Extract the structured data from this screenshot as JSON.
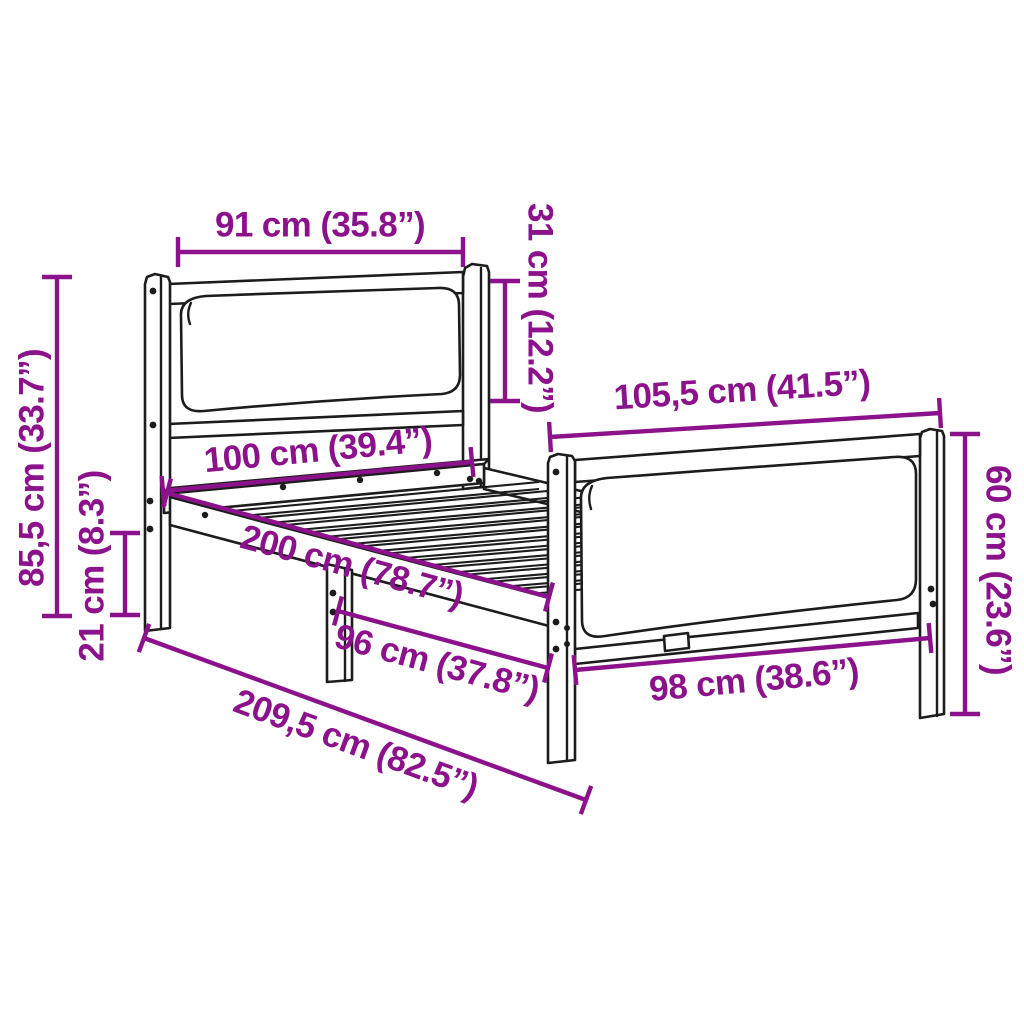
{
  "diagram": {
    "type": "product-dimension-diagram",
    "subject": "bed-frame-with-headboard-and-footboard",
    "colors": {
      "dimension_accent": "#8C128C",
      "outline": "#1c1c1c",
      "background": "#ffffff"
    },
    "dimensions": {
      "headboard_width": "91 cm (35.8”)",
      "headboard_panel_height": "31 cm (12.2”)",
      "headboard_height": "85,5 cm (33.7”)",
      "front_leg_height": "21 cm (8.3”)",
      "bed_width": "100 cm (39.4”)",
      "bed_length": "200 cm (78.7”)",
      "support_span": "96 cm (37.8”)",
      "total_length": "209,5 cm (82.5”)",
      "footboard_width": "105,5 cm (41.5”)",
      "footboard_inner_width": "98 cm (38.6”)",
      "footboard_height": "60 cm (23.6”)"
    }
  }
}
